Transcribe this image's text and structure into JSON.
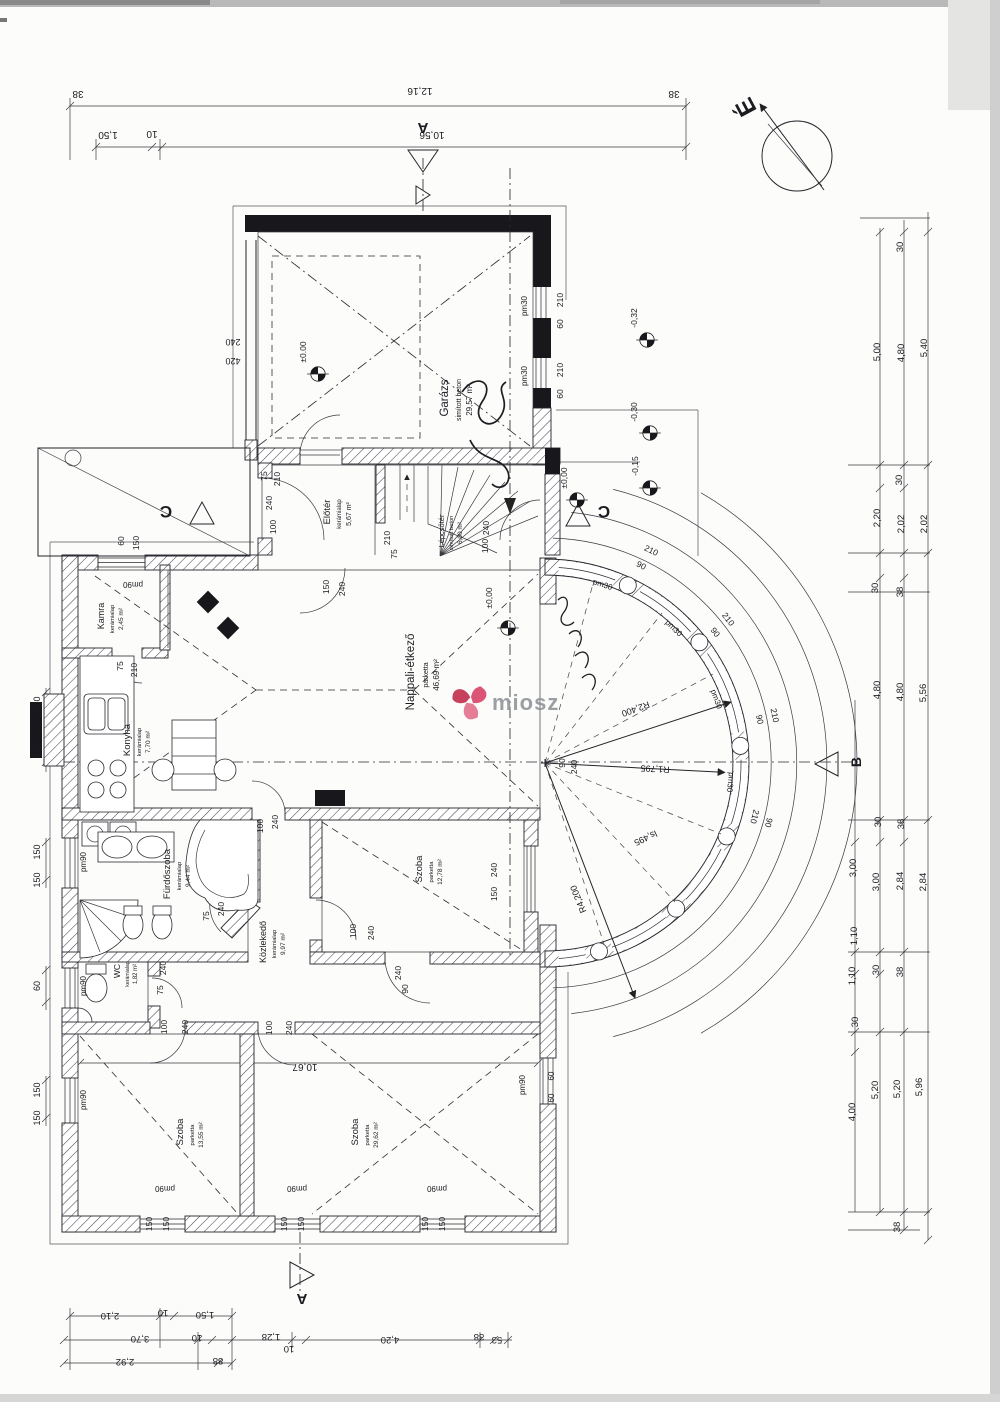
{
  "watermark": {
    "text": "miosz"
  },
  "compass": {
    "label": "É"
  },
  "markers": {
    "a": "A",
    "b": "B",
    "c": "C"
  },
  "rooms": {
    "garage": {
      "name": "Garázs",
      "finish": "simított beton",
      "area": "29,57 m²"
    },
    "eloter": {
      "name": "Előtér",
      "finish": "kerámialap",
      "area": "5,67 m²"
    },
    "lepcso": {
      "name": "Lépcsőtér",
      "finish": "simított beton",
      "area": "6,00 m²"
    },
    "nappali": {
      "name": "Nappali-étkező",
      "finish": "parketta",
      "area": "46,69 m²"
    },
    "kamra": {
      "name": "Kamra",
      "finish": "kerámialap",
      "area": "2,45 m²"
    },
    "konyha": {
      "name": "Konyha",
      "finish": "kerámialap",
      "area": "7,70 m²"
    },
    "furdo": {
      "name": "Fürdőszoba",
      "finish": "kerámialap",
      "area": "9,44 m²"
    },
    "wc": {
      "name": "WC",
      "finish": "kerámialap",
      "area": "1,82 m²"
    },
    "kozlekedo": {
      "name": "Közlekedő",
      "finish": "kerámialap",
      "area": "9,97 m²"
    },
    "szoba_mid": {
      "name": "Szoba",
      "finish": "parketta",
      "area": "12,78 m²"
    },
    "szoba_bl": {
      "name": "Szoba",
      "finish": "parketta",
      "area": "13,55 m²"
    },
    "szoba_br": {
      "name": "Szoba",
      "finish": "parketta",
      "area": "29,62 m²"
    }
  },
  "levels": {
    "zero": "±0,00",
    "zero_dot": "±0.00",
    "m015": "-0,15",
    "m030": "-0,30",
    "m032": "-0,32"
  },
  "radii": {
    "r2400": "R2,400",
    "r1795": "R1,795",
    "r4200": "R4,200",
    "arc": "ls,495"
  },
  "win": {
    "pm30": "pm30",
    "pm90": "pm90"
  },
  "num": {
    "n10": "10",
    "n30": "30",
    "n38": "38",
    "n53": "53",
    "n60": "60",
    "n75": "75",
    "n88": "88",
    "n90": "90",
    "n100": "100",
    "n130": "130",
    "n150": "150",
    "n210": "210",
    "n240": "240",
    "n420": "420"
  },
  "dim": {
    "d12_16": "12,16",
    "d10_56": "10,56",
    "d1_50": "1,50",
    "d2_10": "2,10",
    "d3_70": "3,70",
    "d2_92": "2,92",
    "d1_28": "1,28",
    "d4_20": "4,20",
    "d5_00": "5,00",
    "d4_80": "4,80",
    "d5_40": "5,40",
    "d2_20": "2,20",
    "d2_02": "2,02",
    "d5_56": "5,56",
    "d3_00": "3,00",
    "d2_84": "2,84",
    "d1_10": "1,10",
    "d4_00": "4,00",
    "d5_20": "5,20",
    "d5_96": "5,96",
    "d10_67": "10,67"
  }
}
